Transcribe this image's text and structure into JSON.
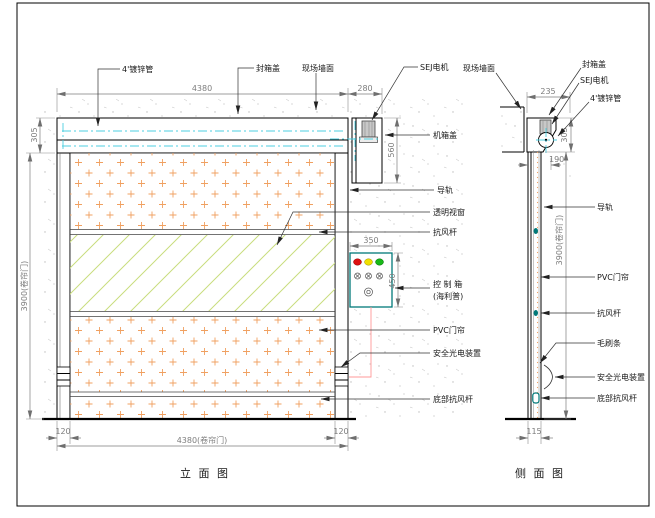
{
  "page": {
    "front_title": "立 面 图",
    "side_title": "侧 面 图"
  },
  "front_view": {
    "labels": {
      "pipe": "4'镀锌管",
      "seal_cover": "封箱盖",
      "wall": "现场墙面",
      "motor": "SEJ电机",
      "machine_cover": "机箱盖",
      "rail": "导轨",
      "window": "透明视窗",
      "wind_bar": "抗风杆",
      "control_box_line1": "控 制 箱",
      "control_box_line2": "(海利普)",
      "curtain": "PVC门帘",
      "safety": "安全光电装置",
      "bottom_bar": "底部抗风杆"
    },
    "dims": {
      "top_width": "4380",
      "motor_box_width": "280",
      "header_height": "305",
      "motor_box_height": "560",
      "door_height": "3900(卷帘门)",
      "left_rail_width": "120",
      "right_rail_width": "120",
      "bottom_width": "4380(卷帘门)",
      "control_box_width": "350",
      "control_box_height": "450"
    }
  },
  "side_view": {
    "labels": {
      "wall": "现场墙面",
      "seal_cover": "封箱盖",
      "motor": "SEJ电机",
      "pipe": "4'镀锌管",
      "rail": "导轨",
      "curtain": "PVC门帘",
      "wind_bar": "抗风杆",
      "brush": "毛刷条",
      "safety": "安全光电装置",
      "bottom_bar": "底部抗风杆"
    },
    "dims": {
      "box_width": "235",
      "box_height": "305",
      "rail_depth": "190",
      "door_height": "3900(卷帘门)",
      "base_width": "115"
    }
  },
  "colors": {
    "centerline_cyan": "#4ccfe0",
    "curtain_dot_orange": "#f0a060",
    "glass_line_green": "#c9dd7e",
    "control_box_teal": "#007878",
    "indicator_red": "#dd1111",
    "indicator_yellow": "#f0e000",
    "indicator_green": "#18b818",
    "wire_red": "#ff9898"
  }
}
